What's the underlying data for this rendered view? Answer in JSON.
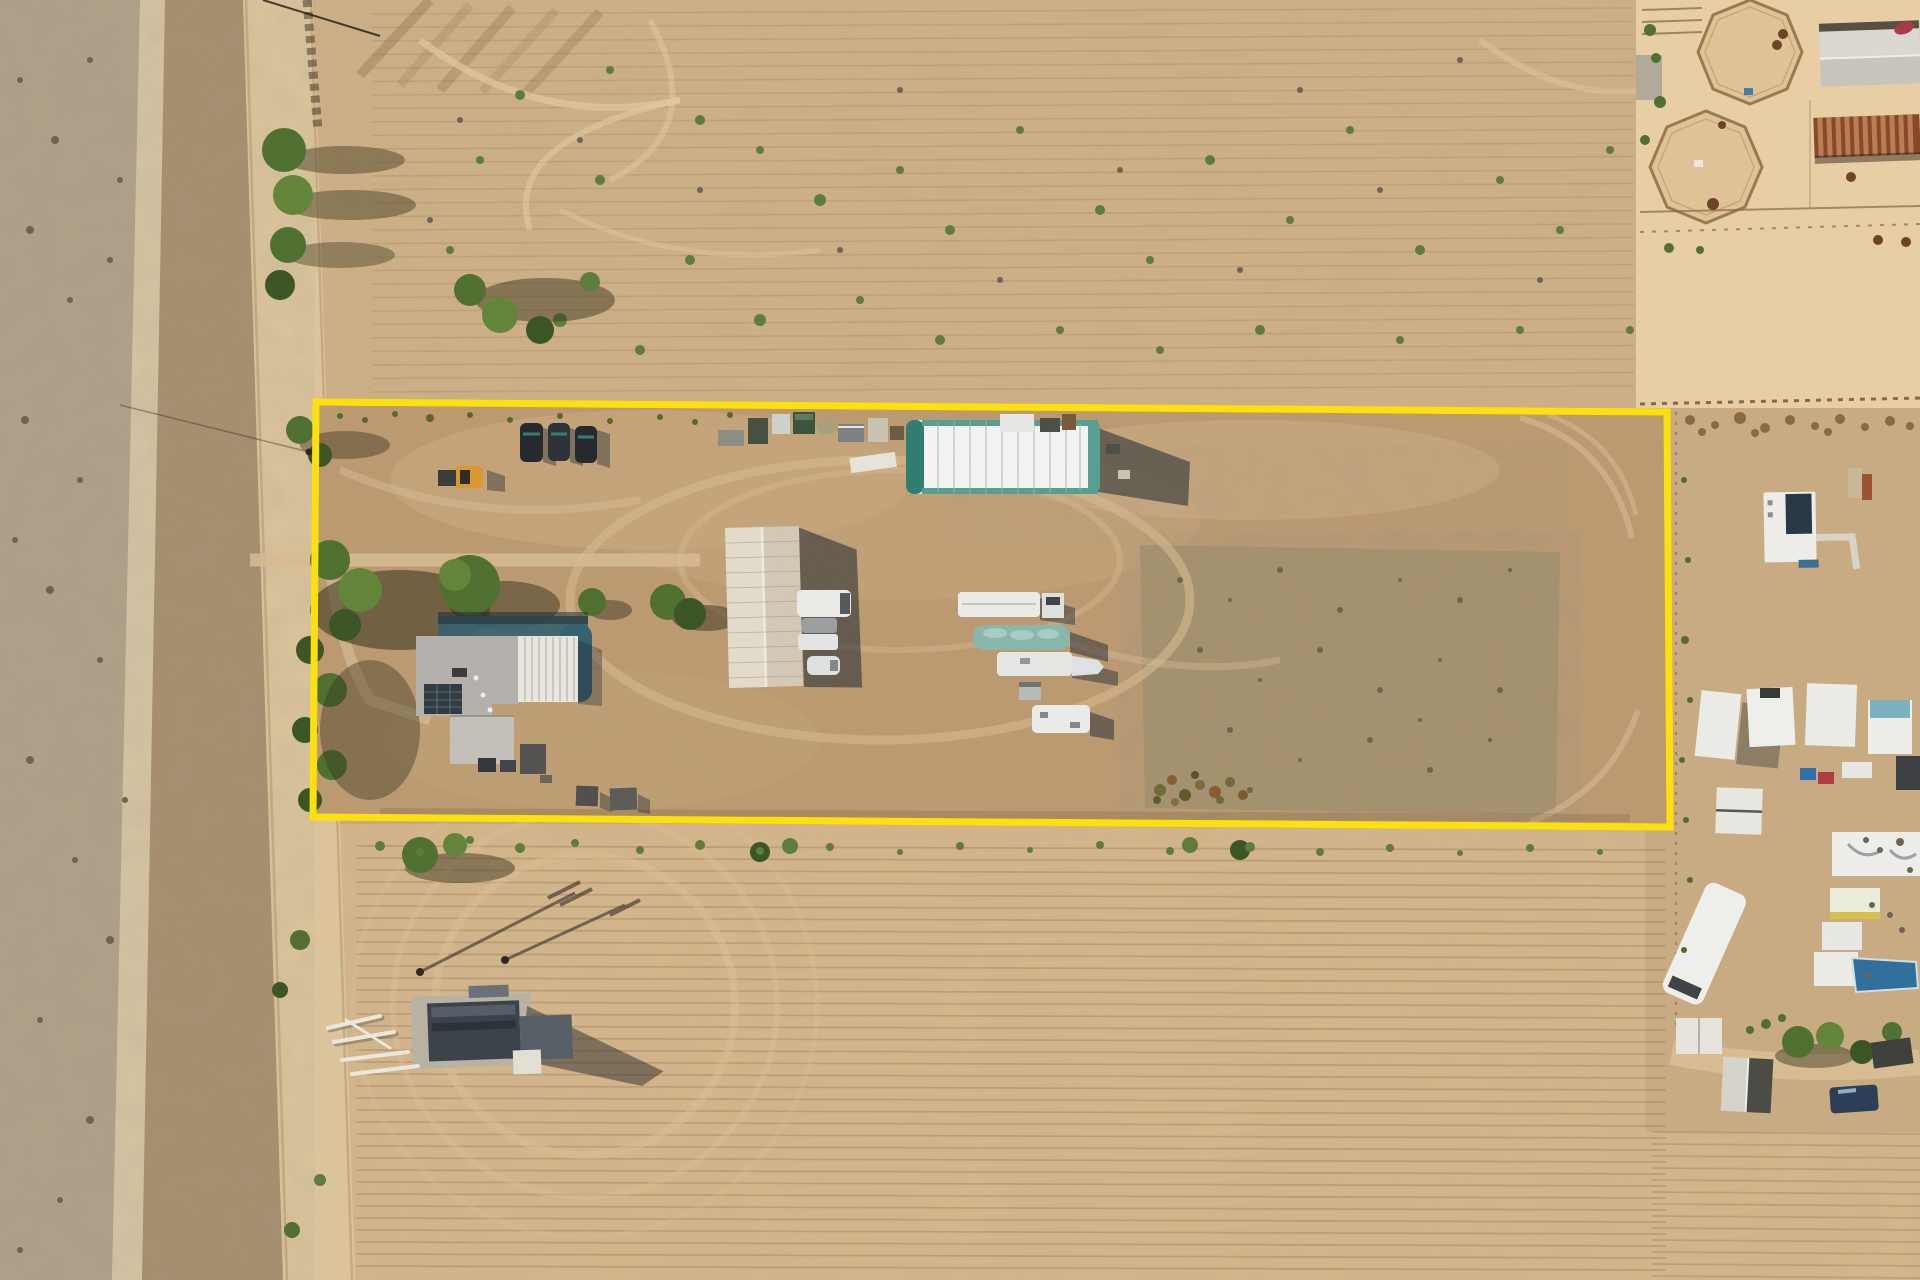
{
  "meta": {
    "scene": "aerial-drone-photo-of-rural-property-with-yellow-parcel-outline",
    "no_visible_text": true
  },
  "palette": {
    "base": "#c9ab80",
    "field_top": "#cfb187",
    "field_bottom": "#d6b78c",
    "yard": "#bc9a72",
    "yard_light": "#cdae85",
    "mottle": "#a6916c",
    "road": "#ddc69d",
    "track": "#d8c6a4",
    "scrub": "#b1a189",
    "shrub_strip": "#a78f6e",
    "horse_sand": "#e9d0a6",
    "right_property": "#c9ac82",
    "boundary_yellow": "#ffe30a",
    "tent_white": "#f4f6f4",
    "tent_teal": "#2f7d71",
    "tent_teal_light": "#55a092",
    "house_roof_gray": "#b4b2ad",
    "house_roof_white": "#eae8e0",
    "solar_panel": "#2e3940",
    "pool_teal": "#33606d",
    "barn_roof_light": "#e5ddcc",
    "barn_roof_dark": "#d5cab7",
    "trailer_white": "#eceeeb",
    "boat_teal": "#8ab8ae",
    "loader_yellow": "#d9992d",
    "car_dark": "#24282c",
    "tree_green": "#4e7030",
    "tree_light": "#628538",
    "tree_dark": "#3a5424",
    "shrub_green": "#5d7c3c",
    "shadow": "#1c2630",
    "rust": "#9d5130",
    "fence_brown": "#7b5e3e",
    "concrete": "#b8b3a6",
    "equipment_dark": "#3a414a",
    "pipe_white": "#eceade",
    "truck_blue": "#2a3d55",
    "item_red": "#b03a42",
    "item_blue": "#2f6fae",
    "item_yellow": "#d9c14a",
    "dot_dark": "#6e6350",
    "horse_brown": "#6d4226",
    "weed_dark": "#55682f",
    "debris_brown": "#8a6a3f"
  },
  "boundary": {
    "points": "316,402 1667,412 1670,827 313,817",
    "width": 7
  },
  "furrows": {
    "top_field": {
      "y0": 14,
      "count": 29,
      "dy": 13.5,
      "x1": 372,
      "x2": 1634,
      "slope": -6,
      "stroke": "#9b7a55",
      "width": 1.6,
      "opacity": 0.26
    },
    "bottom_field": {
      "y0": 846,
      "count": 36,
      "dy": 12,
      "x1": 356,
      "x2": 1666,
      "slope": 4,
      "stroke": "#8f6f4e",
      "width": 1.8,
      "opacity": 0.32
    },
    "bottom_right": {
      "y0": 1132,
      "count": 13,
      "dy": 12,
      "x1": 1652,
      "x2": 1920,
      "slope": 2,
      "stroke": "#8f6f4e",
      "width": 1.8,
      "opacity": 0.3
    }
  },
  "scatter": {
    "field_shrubs": [
      [
        520,
        95,
        5
      ],
      [
        610,
        70,
        4
      ],
      [
        700,
        120,
        5
      ],
      [
        760,
        150,
        4
      ],
      [
        820,
        200,
        6
      ],
      [
        900,
        170,
        4
      ],
      [
        950,
        230,
        5
      ],
      [
        1020,
        130,
        4
      ],
      [
        1100,
        210,
        5
      ],
      [
        1150,
        260,
        4
      ],
      [
        1210,
        160,
        5
      ],
      [
        1290,
        220,
        4
      ],
      [
        1350,
        130,
        4
      ],
      [
        1420,
        250,
        5
      ],
      [
        1500,
        180,
        4
      ],
      [
        1560,
        230,
        4
      ],
      [
        1610,
        150,
        4
      ],
      [
        690,
        260,
        5
      ],
      [
        760,
        320,
        6
      ],
      [
        860,
        300,
        4
      ],
      [
        940,
        340,
        5
      ],
      [
        1060,
        330,
        4
      ],
      [
        1160,
        350,
        4
      ],
      [
        1260,
        330,
        5
      ],
      [
        1400,
        340,
        4
      ],
      [
        1520,
        330,
        4
      ],
      [
        600,
        180,
        5
      ],
      [
        560,
        320,
        7
      ],
      [
        640,
        350,
        5
      ],
      [
        480,
        160,
        4
      ],
      [
        450,
        250,
        4
      ],
      [
        1650,
        90,
        4
      ],
      [
        1630,
        330,
        4
      ]
    ],
    "field_dots": [
      [
        580,
        140,
        3
      ],
      [
        700,
        190,
        3
      ],
      [
        840,
        250,
        3
      ],
      [
        1000,
        280,
        3
      ],
      [
        1120,
        170,
        3
      ],
      [
        1240,
        270,
        3
      ],
      [
        1380,
        190,
        3
      ],
      [
        1540,
        280,
        3
      ],
      [
        460,
        120,
        3
      ],
      [
        430,
        220,
        3
      ],
      [
        900,
        90,
        3
      ],
      [
        1300,
        90,
        3
      ],
      [
        1460,
        60,
        3
      ]
    ],
    "scrub_dots": [
      [
        20,
        80,
        3
      ],
      [
        55,
        140,
        4
      ],
      [
        90,
        60,
        3
      ],
      [
        30,
        230,
        4
      ],
      [
        70,
        300,
        3
      ],
      [
        110,
        260,
        3
      ],
      [
        25,
        420,
        4
      ],
      [
        80,
        480,
        3
      ],
      [
        50,
        590,
        4
      ],
      [
        100,
        660,
        3
      ],
      [
        30,
        760,
        4
      ],
      [
        75,
        860,
        3
      ],
      [
        110,
        940,
        4
      ],
      [
        40,
        1020,
        3
      ],
      [
        90,
        1120,
        4
      ],
      [
        60,
        1200,
        3
      ],
      [
        20,
        1250,
        3
      ],
      [
        120,
        180,
        3
      ],
      [
        15,
        540,
        3
      ],
      [
        125,
        800,
        3
      ]
    ],
    "weeds_top": [
      [
        340,
        416,
        3
      ],
      [
        365,
        420,
        3
      ],
      [
        395,
        414,
        3
      ],
      [
        430,
        418,
        4
      ],
      [
        470,
        415,
        3
      ],
      [
        510,
        420,
        3
      ],
      [
        560,
        416,
        3
      ],
      [
        610,
        421,
        3
      ],
      [
        660,
        417,
        3
      ],
      [
        695,
        422,
        3
      ],
      [
        730,
        415,
        3
      ]
    ],
    "weeds_bottom": [
      [
        380,
        846,
        5
      ],
      [
        420,
        852,
        4
      ],
      [
        470,
        840,
        4
      ],
      [
        520,
        848,
        5
      ],
      [
        575,
        843,
        4
      ],
      [
        640,
        850,
        4
      ],
      [
        700,
        845,
        5
      ],
      [
        760,
        851,
        4
      ],
      [
        830,
        847,
        4
      ],
      [
        900,
        852,
        3
      ],
      [
        960,
        846,
        4
      ],
      [
        1030,
        850,
        3
      ],
      [
        1100,
        845,
        4
      ],
      [
        1170,
        851,
        4
      ],
      [
        1250,
        847,
        5
      ],
      [
        1320,
        852,
        4
      ],
      [
        1390,
        848,
        4
      ],
      [
        1460,
        853,
        3
      ],
      [
        1530,
        848,
        4
      ],
      [
        1600,
        852,
        3
      ]
    ],
    "junk_pile": [
      [
        1160,
        790,
        6,
        "#6f6a35"
      ],
      [
        1172,
        780,
        5,
        "#8a5a2f"
      ],
      [
        1185,
        795,
        6,
        "#5d5a2e"
      ],
      [
        1200,
        785,
        5,
        "#7a6a33"
      ],
      [
        1215,
        792,
        6,
        "#8a5a2f"
      ],
      [
        1230,
        782,
        5,
        "#6f6a35"
      ],
      [
        1243,
        795,
        5,
        "#7a5a30"
      ],
      [
        1195,
        775,
        4,
        "#56522a"
      ],
      [
        1220,
        800,
        4,
        "#6f6a35"
      ],
      [
        1175,
        802,
        4,
        "#8a6a3f"
      ],
      [
        1157,
        800,
        4,
        "#5d5a2e"
      ]
    ],
    "right_weeds": [
      [
        1690,
        420,
        5
      ],
      [
        1715,
        425,
        4
      ],
      [
        1740,
        418,
        6
      ],
      [
        1765,
        428,
        5
      ],
      [
        1790,
        420,
        5
      ],
      [
        1815,
        426,
        4
      ],
      [
        1840,
        419,
        5
      ],
      [
        1865,
        427,
        4
      ],
      [
        1890,
        421,
        5
      ],
      [
        1910,
        426,
        4
      ],
      [
        1702,
        432,
        4
      ],
      [
        1755,
        433,
        4
      ],
      [
        1828,
        432,
        4
      ]
    ],
    "fence_greens": [
      [
        1685,
        640,
        4
      ],
      [
        1690,
        700,
        3
      ],
      [
        1682,
        760,
        3
      ],
      [
        1688,
        560,
        3
      ],
      [
        1684,
        480,
        3
      ],
      [
        1686,
        820,
        3
      ],
      [
        1690,
        880,
        3
      ],
      [
        1684,
        950,
        3
      ]
    ],
    "horse_bushes": [
      [
        1650,
        30,
        6
      ],
      [
        1656,
        58,
        5
      ],
      [
        1660,
        102,
        6
      ],
      [
        1645,
        140,
        5
      ],
      [
        1669,
        248,
        5
      ],
      [
        1700,
        250,
        4
      ]
    ],
    "mottle_dots": [
      [
        1180,
        580,
        3
      ],
      [
        1230,
        600,
        2
      ],
      [
        1280,
        570,
        3
      ],
      [
        1340,
        610,
        3
      ],
      [
        1400,
        580,
        2
      ],
      [
        1460,
        600,
        3
      ],
      [
        1510,
        570,
        2
      ],
      [
        1200,
        650,
        3
      ],
      [
        1260,
        680,
        2
      ],
      [
        1320,
        650,
        3
      ],
      [
        1380,
        690,
        3
      ],
      [
        1440,
        660,
        2
      ],
      [
        1500,
        690,
        3
      ],
      [
        1230,
        730,
        3
      ],
      [
        1300,
        760,
        2
      ],
      [
        1370,
        740,
        3
      ],
      [
        1430,
        770,
        3
      ],
      [
        1490,
        740,
        2
      ],
      [
        1250,
        790,
        3
      ],
      [
        1420,
        720,
        2
      ]
    ],
    "cluster_junk": [
      [
        1866,
        840,
        3
      ],
      [
        1880,
        850,
        3
      ],
      [
        1900,
        842,
        4
      ],
      [
        1872,
        905,
        3
      ],
      [
        1890,
        915,
        3
      ],
      [
        1902,
        930,
        3
      ],
      [
        1868,
        975,
        3
      ],
      [
        1910,
        870,
        3
      ]
    ],
    "shed_greens": [
      [
        1766,
        1024,
        5
      ],
      [
        1782,
        1018,
        4
      ],
      [
        1750,
        1030,
        4
      ]
    ],
    "horses": [
      [
        1783,
        34,
        5
      ],
      [
        1777,
        45,
        5
      ],
      [
        1713,
        204,
        6
      ],
      [
        1851,
        177,
        5
      ],
      [
        1878,
        240,
        5
      ],
      [
        1906,
        242,
        5
      ],
      [
        1722,
        125,
        4
      ]
    ]
  }
}
